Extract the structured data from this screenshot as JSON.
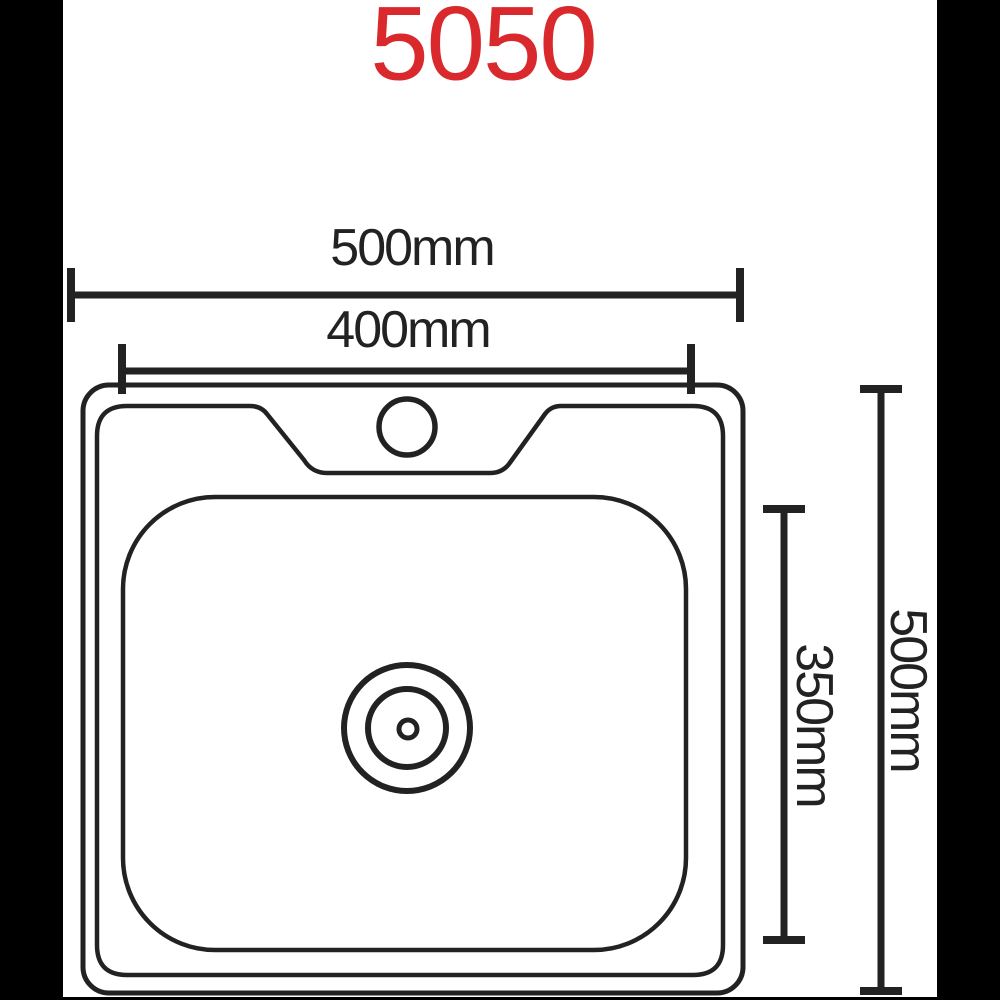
{
  "title": {
    "text": "5050",
    "color": "#d9292c"
  },
  "colors": {
    "background": "#ffffff",
    "line": "#222222",
    "letterbox": "#000000"
  },
  "dimensions": {
    "overall_width": {
      "label": "500mm"
    },
    "bowl_width": {
      "label": "400mm"
    },
    "bowl_depth": {
      "label": "350mm"
    },
    "overall_depth": {
      "label": "500mm"
    }
  }
}
